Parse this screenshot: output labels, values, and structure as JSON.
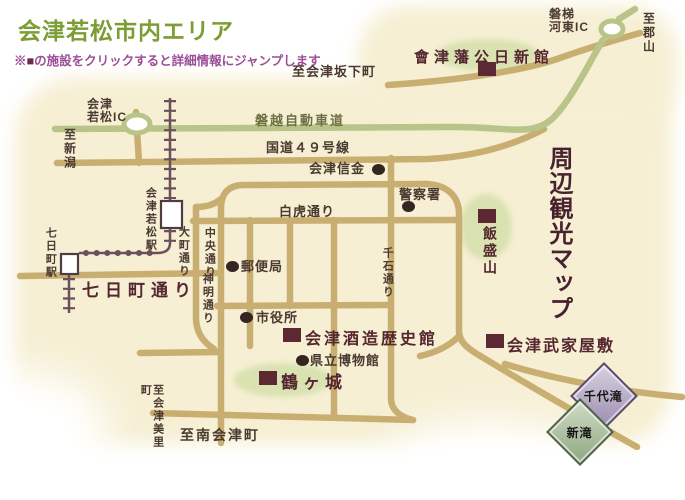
{
  "header": {
    "title": "会津若松市内エリア",
    "note_prefix": "※",
    "note_marker": "■",
    "note_suffix": "の施設をクリックすると詳細情報にジャンプします"
  },
  "map": {
    "title_vertical": "周辺観光マップ",
    "expressway_label": "磐越自動車道",
    "route49_label": "国道４９号線",
    "roads": {
      "byakko": "白虎通り",
      "nanukamachi": "七日町通り",
      "omachi": "大町通り",
      "chuo": "中央通り",
      "shinmei": "神明通り",
      "sengoku": "千石通り"
    },
    "destinations": {
      "koriyama": "至郡山",
      "niigata": "至新潟",
      "bange": "至会津坂下町",
      "misato": "至会津美里町",
      "minamiaizu": "至南会津町"
    },
    "interchanges": {
      "wakamatsu": "会津\n若松IC",
      "kawahigashi": "磐梯\n河東IC"
    },
    "stations": {
      "aizuwakamatsu": "会津若松駅",
      "nanukamachi": "七日町駅"
    },
    "pois": {
      "shinkin": "会津信金",
      "police": "警察署",
      "post_office": "郵便局",
      "city_hall": "市役所",
      "museum": "県立博物館"
    },
    "facilities": {
      "nisshinkan": "會津藩公日新館",
      "iimoriyama": "飯盛山",
      "sake_museum": "会津酒造歴史館",
      "tsurugajo": "鶴ヶ城",
      "bukeyashiki": "会津武家屋敷"
    },
    "logos": {
      "chiyotaki": "千代滝",
      "shintaki": "新滝"
    }
  },
  "colors": {
    "road": "#c9ae72",
    "expressway": "#b9c488",
    "railway": "#6b505b",
    "facility_marker": "#5c2833",
    "highlight_green": "#d4e0ab",
    "title_green": "#7c9c34",
    "note_purple": "#9b4d98",
    "brush_text": "#54262f",
    "background_cream": "#f6efd3"
  }
}
